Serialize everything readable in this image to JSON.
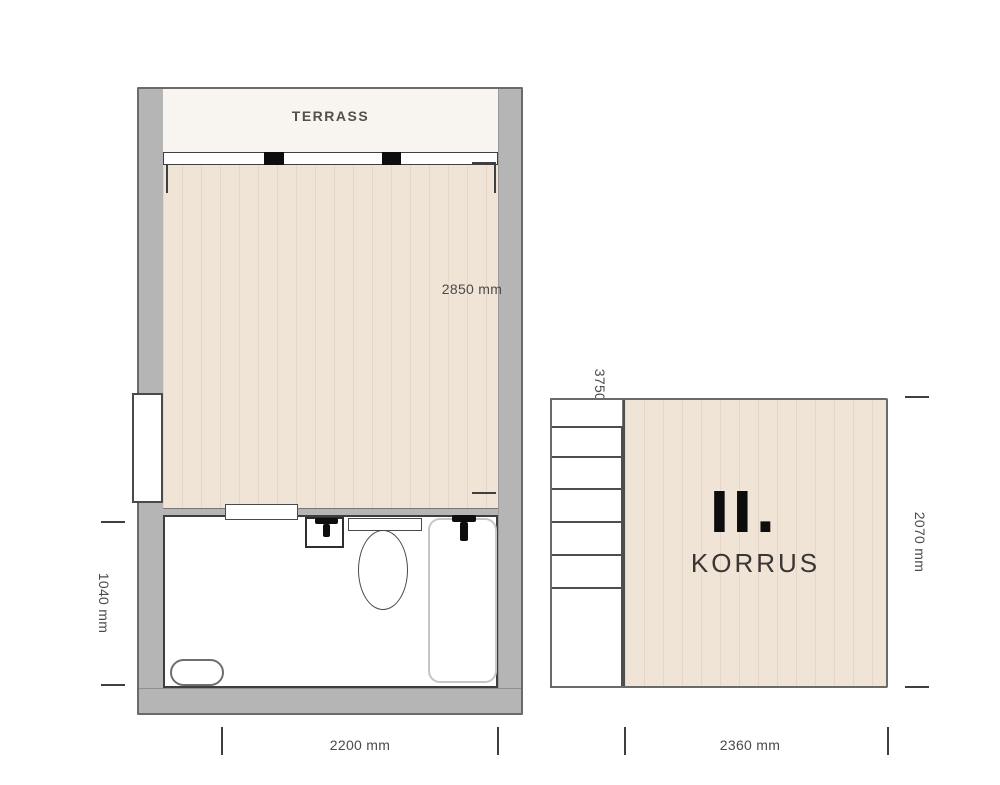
{
  "floor1": {
    "terrace_label": "TERRASS",
    "dimensions": {
      "room_width": "2850 mm",
      "room_depth": "3750 mm",
      "bathroom_depth": "1040 mm",
      "unit_width": "2200 mm"
    },
    "fixtures": [
      "sliding-glass-door",
      "side-window",
      "pass-through-window",
      "sink",
      "toilet",
      "shower",
      "bath-mat"
    ]
  },
  "floor2": {
    "numeral": "II.",
    "label": "KORRUS",
    "dimensions": {
      "depth": "2070 mm",
      "width": "2360 mm"
    },
    "fixtures": [
      "staircase"
    ]
  },
  "colors": {
    "wall": "#b5b5b5",
    "wood": "#f0e4d7",
    "terrace": "#f8f5f1",
    "outline": "#4d4d4d",
    "fixture": "#0d0d0d",
    "dim": "#4a4a4a"
  }
}
